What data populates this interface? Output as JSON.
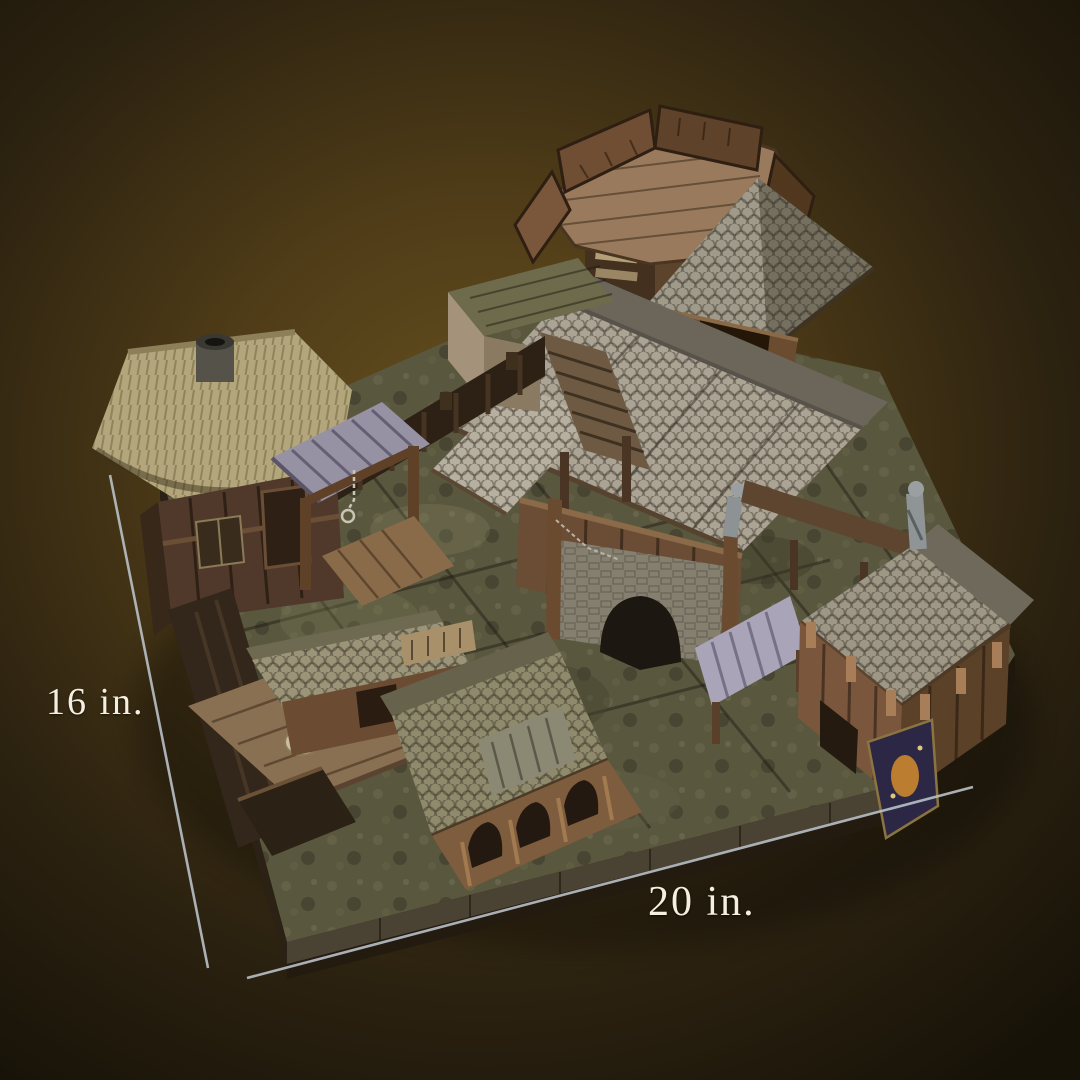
{
  "background": {
    "center_color": "#66501f",
    "edge_color": "#171208"
  },
  "annotations": {
    "height": {
      "label": "16 in."
    },
    "width": {
      "label": "20 in."
    },
    "line_color": "#b9c0c8",
    "text_color": "#f5efdf"
  },
  "model": {
    "subject": "wooden fantasy village tabletop terrain",
    "parts": [
      "terrain-base",
      "watchtower",
      "pyramid-roof-annex",
      "great-hall",
      "stone-gate",
      "stairs-annex",
      "thatched-hut",
      "gallows-shed",
      "slate-lean-to",
      "gatehouse",
      "banner",
      "market-stall",
      "smithy",
      "deck-platform",
      "palisade"
    ]
  }
}
